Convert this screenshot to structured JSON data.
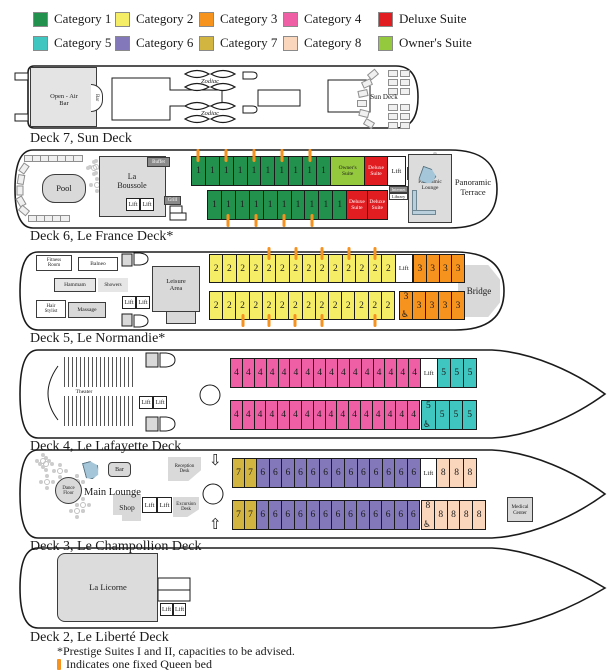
{
  "legend": {
    "items": [
      {
        "label": "Category 1",
        "color": "#23914E"
      },
      {
        "label": "Category 2",
        "color": "#F6ED67"
      },
      {
        "label": "Category 3",
        "color": "#F6921E"
      },
      {
        "label": "Category 4",
        "color": "#EE5FA5"
      },
      {
        "label": "Deluxe Suite",
        "color": "#E11D22"
      },
      {
        "label": "Category 5",
        "color": "#3FC6C0"
      },
      {
        "label": "Category 6",
        "color": "#8278BA"
      },
      {
        "label": "Category 7",
        "color": "#D2B440"
      },
      {
        "label": "Category 8",
        "color": "#FAD6BD"
      },
      {
        "label": "Owner's Suite",
        "color": "#94C83D"
      }
    ]
  },
  "colors": {
    "cat1": "#23914E",
    "cat2": "#F6ED67",
    "cat3": "#F6921E",
    "cat4": "#EE5FA5",
    "deluxe": "#E11D22",
    "cat5": "#3FC6C0",
    "cat6": "#8278BA",
    "cat7": "#D2B440",
    "cat8": "#FAD6BD",
    "owners": "#94C83D",
    "lift": "#FFFFFF",
    "marker": "#F6921E"
  },
  "icons": {
    "wheelchair": "♿"
  },
  "decks": {
    "deck7": {
      "label": "Deck 7, Sun Deck",
      "texts": {
        "open_air_bar": "Open - Air\nBar",
        "bar": "Bar",
        "zodiac": "Zodiac",
        "sun_deck": "Sun Deck"
      }
    },
    "deck6": {
      "label": "Deck 6, Le France Deck*",
      "rooms": {
        "pool": "Pool",
        "restaurant": "La\nBoussole",
        "buffet": "Buffet",
        "grill": "Grill",
        "lift": "Lift",
        "bar": "Bar",
        "internet": "Internet",
        "library": "Library",
        "pano_lounge": "Panoramic\nLounge",
        "pano_terrace": "Panoramic\nTerrace"
      },
      "rows": {
        "top": [
          {
            "t": "1",
            "c": "cat1",
            "m": "t"
          },
          {
            "t": "1",
            "c": "cat1"
          },
          {
            "t": "1",
            "c": "cat1",
            "m": "t"
          },
          {
            "t": "1",
            "c": "cat1"
          },
          {
            "t": "1",
            "c": "cat1",
            "m": "t"
          },
          {
            "t": "1",
            "c": "cat1"
          },
          {
            "t": "1",
            "c": "cat1",
            "m": "t"
          },
          {
            "t": "1",
            "c": "cat1"
          },
          {
            "t": "1",
            "c": "cat1",
            "m": "t"
          },
          {
            "t": "1",
            "c": "cat1"
          },
          {
            "t": "Owner's\nSuite",
            "c": "owners",
            "w": 2.6,
            "s": 1
          },
          {
            "t": "Deluxe\nSuite",
            "c": "deluxe",
            "w": 1.65,
            "s": 1,
            "lt": 1
          },
          {
            "t": "Lift",
            "c": "lift",
            "w": 1.35,
            "lift": 1
          }
        ],
        "bottom": [
          {
            "t": "1",
            "c": "cat1"
          },
          {
            "t": "1",
            "c": "cat1",
            "m": "b"
          },
          {
            "t": "1",
            "c": "cat1"
          },
          {
            "t": "1",
            "c": "cat1",
            "m": "b"
          },
          {
            "t": "1",
            "c": "cat1"
          },
          {
            "t": "1",
            "c": "cat1",
            "m": "b"
          },
          {
            "t": "1",
            "c": "cat1"
          },
          {
            "t": "1",
            "c": "cat1",
            "m": "b"
          },
          {
            "t": "1",
            "c": "cat1"
          },
          {
            "t": "1",
            "c": "cat1"
          },
          {
            "t": "Deluxe\nSuite",
            "c": "deluxe",
            "w": 1.5,
            "s": 1,
            "lt": 1
          },
          {
            "t": "Deluxe\nSuite",
            "c": "deluxe",
            "w": 1.5,
            "s": 1,
            "lt": 1
          }
        ]
      }
    },
    "deck5": {
      "label": "Deck 5, Le Normandie*",
      "rooms": {
        "fitness": "Fitness\nRoom",
        "balneo": "Balneo",
        "hammam": "Hammam",
        "showers": "Showers",
        "hair": "Hair\nStylist",
        "massage": "Massage",
        "lift": "Lift",
        "leisure": "Leisure\nArea",
        "bridge": "Bridge"
      },
      "rows": {
        "topA": [
          {
            "t": "2",
            "c": "cat2"
          },
          {
            "t": "2",
            "c": "cat2"
          },
          {
            "t": "2",
            "c": "cat2"
          },
          {
            "t": "2",
            "c": "cat2"
          },
          {
            "t": "2",
            "c": "cat2",
            "m": "t"
          },
          {
            "t": "2",
            "c": "cat2"
          },
          {
            "t": "2",
            "c": "cat2",
            "m": "t"
          },
          {
            "t": "2",
            "c": "cat2"
          },
          {
            "t": "2",
            "c": "cat2",
            "m": "t"
          },
          {
            "t": "2",
            "c": "cat2"
          },
          {
            "t": "2",
            "c": "cat2",
            "m": "t"
          },
          {
            "t": "2",
            "c": "cat2"
          },
          {
            "t": "2",
            "c": "cat2",
            "m": "t"
          },
          {
            "t": "2",
            "c": "cat2"
          },
          {
            "t": "Lift",
            "c": "lift",
            "w": 1.35,
            "lift": 1
          }
        ],
        "topB": [
          {
            "t": "3",
            "c": "cat3"
          },
          {
            "t": "3",
            "c": "cat3"
          },
          {
            "t": "3",
            "c": "cat3"
          },
          {
            "t": "3",
            "c": "cat3"
          }
        ],
        "botA": [
          {
            "t": "2",
            "c": "cat2"
          },
          {
            "t": "2",
            "c": "cat2"
          },
          {
            "t": "2",
            "c": "cat2",
            "m": "b"
          },
          {
            "t": "2",
            "c": "cat2"
          },
          {
            "t": "2",
            "c": "cat2",
            "m": "b"
          },
          {
            "t": "2",
            "c": "cat2"
          },
          {
            "t": "2",
            "c": "cat2",
            "m": "b"
          },
          {
            "t": "2",
            "c": "cat2"
          },
          {
            "t": "2",
            "c": "cat2",
            "m": "b"
          },
          {
            "t": "2",
            "c": "cat2"
          },
          {
            "t": "2",
            "c": "cat2"
          },
          {
            "t": "2",
            "c": "cat2"
          },
          {
            "t": "2",
            "c": "cat2",
            "m": "b"
          },
          {
            "t": "2",
            "c": "cat2"
          }
        ],
        "botB": [
          {
            "t": "3",
            "c": "cat3",
            "wc": 1
          },
          {
            "t": "3",
            "c": "cat3"
          },
          {
            "t": "3",
            "c": "cat3"
          },
          {
            "t": "3",
            "c": "cat3"
          },
          {
            "t": "3",
            "c": "cat3"
          }
        ]
      }
    },
    "deck4": {
      "label": "Deck 4, Le Lafayette Deck",
      "rooms": {
        "theater": "Theater",
        "lift": "Lift"
      },
      "rows": {
        "topA": [
          {
            "t": "4",
            "c": "cat4"
          },
          {
            "t": "4",
            "c": "cat4"
          },
          {
            "t": "4",
            "c": "cat4"
          },
          {
            "t": "4",
            "c": "cat4"
          },
          {
            "t": "4",
            "c": "cat4"
          },
          {
            "t": "4",
            "c": "cat4"
          },
          {
            "t": "4",
            "c": "cat4"
          },
          {
            "t": "4",
            "c": "cat4"
          },
          {
            "t": "4",
            "c": "cat4"
          },
          {
            "t": "4",
            "c": "cat4"
          },
          {
            "t": "4",
            "c": "cat4"
          },
          {
            "t": "4",
            "c": "cat4"
          },
          {
            "t": "4",
            "c": "cat4"
          },
          {
            "t": "4",
            "c": "cat4"
          },
          {
            "t": "4",
            "c": "cat4"
          },
          {
            "t": "4",
            "c": "cat4"
          },
          {
            "t": "Lift",
            "c": "lift",
            "w": 1.43,
            "lift": 1
          },
          {
            "t": "5",
            "c": "cat5",
            "w": 1.12
          },
          {
            "t": "5",
            "c": "cat5",
            "w": 1.12
          },
          {
            "t": "5",
            "c": "cat5",
            "w": 1.12
          }
        ],
        "botA": [
          {
            "t": "4",
            "c": "cat4"
          },
          {
            "t": "4",
            "c": "cat4"
          },
          {
            "t": "4",
            "c": "cat4"
          },
          {
            "t": "4",
            "c": "cat4"
          },
          {
            "t": "4",
            "c": "cat4"
          },
          {
            "t": "4",
            "c": "cat4"
          },
          {
            "t": "4",
            "c": "cat4"
          },
          {
            "t": "4",
            "c": "cat4"
          },
          {
            "t": "4",
            "c": "cat4"
          },
          {
            "t": "4",
            "c": "cat4"
          },
          {
            "t": "4",
            "c": "cat4"
          },
          {
            "t": "4",
            "c": "cat4"
          },
          {
            "t": "4",
            "c": "cat4"
          },
          {
            "t": "4",
            "c": "cat4"
          },
          {
            "t": "4",
            "c": "cat4"
          },
          {
            "t": "4",
            "c": "cat4"
          }
        ],
        "botB": [
          {
            "t": "5",
            "c": "cat5",
            "wc": 1
          },
          {
            "t": "5",
            "c": "cat5"
          },
          {
            "t": "5",
            "c": "cat5"
          },
          {
            "t": "5",
            "c": "cat5"
          }
        ]
      }
    },
    "deck3": {
      "label": "Deck 3, Le Champollion Deck",
      "rooms": {
        "dance": "Dance\nFloor",
        "main_lounge": "Main Lounge",
        "bar": "Bar",
        "reception": "Reception\nDesk",
        "shop": "Shop",
        "lift": "Lift",
        "excursion": "Excursion\nDesk",
        "medical": "Medical\nCenter"
      },
      "rows": {
        "topA": [
          {
            "t": "7",
            "c": "cat7",
            "w": 0.95
          },
          {
            "t": "7",
            "c": "cat7",
            "w": 0.95
          },
          {
            "t": "6",
            "c": "cat6"
          },
          {
            "t": "6",
            "c": "cat6"
          },
          {
            "t": "6",
            "c": "cat6"
          },
          {
            "t": "6",
            "c": "cat6"
          },
          {
            "t": "6",
            "c": "cat6"
          },
          {
            "t": "6",
            "c": "cat6"
          },
          {
            "t": "6",
            "c": "cat6"
          },
          {
            "t": "6",
            "c": "cat6"
          },
          {
            "t": "6",
            "c": "cat6"
          },
          {
            "t": "6",
            "c": "cat6"
          },
          {
            "t": "6",
            "c": "cat6"
          },
          {
            "t": "6",
            "c": "cat6"
          },
          {
            "t": "6",
            "c": "cat6"
          },
          {
            "t": "Lift",
            "c": "lift",
            "w": 1.35,
            "lift": 1
          },
          {
            "t": "8",
            "c": "cat8",
            "w": 1.06
          },
          {
            "t": "8",
            "c": "cat8",
            "w": 1.06
          },
          {
            "t": "8",
            "c": "cat8",
            "w": 1.06
          }
        ],
        "botA": [
          {
            "t": "7",
            "c": "cat7",
            "w": 0.95
          },
          {
            "t": "7",
            "c": "cat7",
            "w": 0.95
          },
          {
            "t": "6",
            "c": "cat6"
          },
          {
            "t": "6",
            "c": "cat6"
          },
          {
            "t": "6",
            "c": "cat6"
          },
          {
            "t": "6",
            "c": "cat6"
          },
          {
            "t": "6",
            "c": "cat6"
          },
          {
            "t": "6",
            "c": "cat6"
          },
          {
            "t": "6",
            "c": "cat6"
          },
          {
            "t": "6",
            "c": "cat6"
          },
          {
            "t": "6",
            "c": "cat6"
          },
          {
            "t": "6",
            "c": "cat6"
          },
          {
            "t": "6",
            "c": "cat6"
          },
          {
            "t": "6",
            "c": "cat6"
          },
          {
            "t": "6",
            "c": "cat6"
          }
        ],
        "botB": [
          {
            "t": "8",
            "c": "cat8",
            "wc": 1
          },
          {
            "t": "8",
            "c": "cat8"
          },
          {
            "t": "8",
            "c": "cat8"
          },
          {
            "t": "8",
            "c": "cat8"
          },
          {
            "t": "8",
            "c": "cat8"
          }
        ]
      }
    },
    "deck2": {
      "label": "Deck 2, Le Liberté Deck",
      "rooms": {
        "restaurant": "La Licorne",
        "lift": "Lift"
      }
    }
  },
  "footnotes": {
    "prestige": "*Prestige Suites I and II, capacities to be advised.",
    "queen": "Indicates one fixed Queen bed"
  }
}
